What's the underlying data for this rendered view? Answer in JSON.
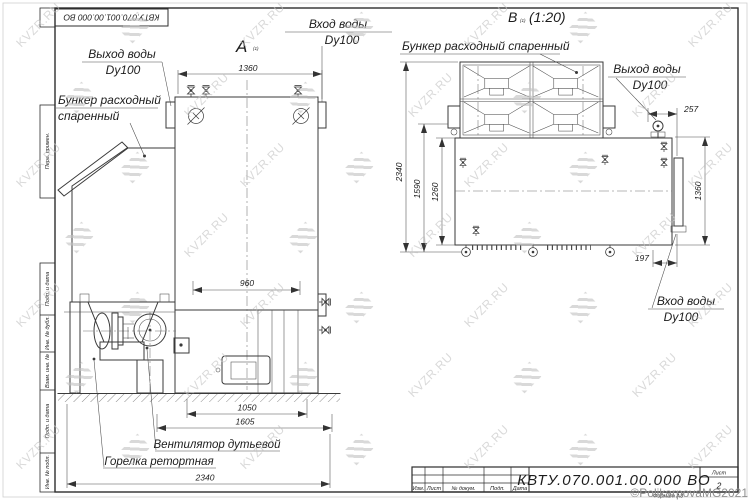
{
  "watermark": {
    "text": "KVZR.RU",
    "color": "#c3c3c3"
  },
  "copyright_text": "©PolikarpovaMG2021",
  "frame": {
    "top_doc_number": "КВТУ.070.001.00.000  ВО",
    "margin": [
      "Перв. примен.",
      "Подп. и дата",
      "Инв. № дубл.",
      "Взам. инв. №",
      "Подп. и дата",
      "Инв. № подл."
    ]
  },
  "title_block": {
    "doc_number": "КВТУ.070.001.00.000  ВО",
    "cols": [
      "Изм.",
      "Лист",
      "№ докум.",
      "Подп.",
      "Дата"
    ],
    "sheet_label": "Лист",
    "sheet_number": "2",
    "format_label": "Формат А3"
  },
  "view_a": {
    "title": "А",
    "title_note": "(1)",
    "out_label1": "Выход воды",
    "out_label2": "Dy100",
    "bunker_label1": "Бункер расходный",
    "bunker_label2": "спаренный",
    "in_label1": "Вход воды",
    "in_label2": "Dy100",
    "fan_label": "Вентилятор дутьевой",
    "burner_label": "Горелка ретортная",
    "dim_top": "1360",
    "dim_mid": "960",
    "dim_b1": "1050",
    "dim_b2": "1605",
    "dim_b3": "2340"
  },
  "view_b": {
    "title": "В",
    "title_note": "(1)",
    "title_scale": "(1:20)",
    "bunker_label": "Бункер расходный спаренный",
    "out_label1": "Выход воды",
    "out_label2": "Dy100",
    "in_label1": "Вход воды",
    "in_label2": "Dy100",
    "dim_left_outer": "2340",
    "dim_left_mid": "1590",
    "dim_left_inner": "1260",
    "dim_top": "257",
    "dim_right": "1360",
    "dim_bottom": "197"
  }
}
